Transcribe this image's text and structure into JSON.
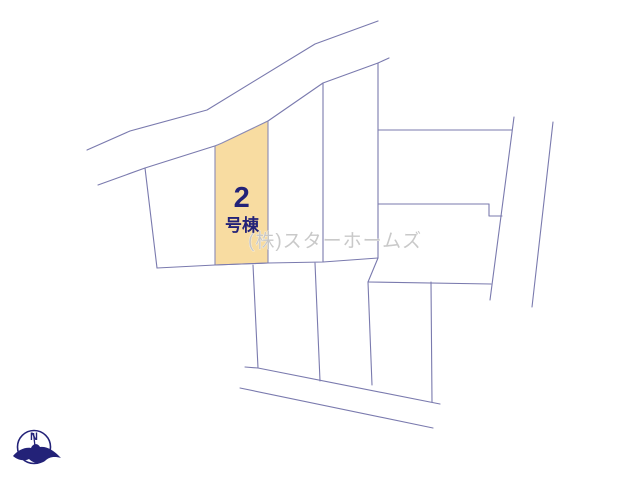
{
  "plot_map": {
    "highlighted_lot": {
      "number": "2",
      "suffix": "号棟"
    },
    "watermark": "(株)スターホームズ",
    "compass": {
      "north_label": "N"
    },
    "colors": {
      "lot_line": "#7a7aae",
      "highlight_fill": "#f8dca1",
      "text_navy": "#232278",
      "watermark_gray": "#c7c7c7"
    }
  }
}
